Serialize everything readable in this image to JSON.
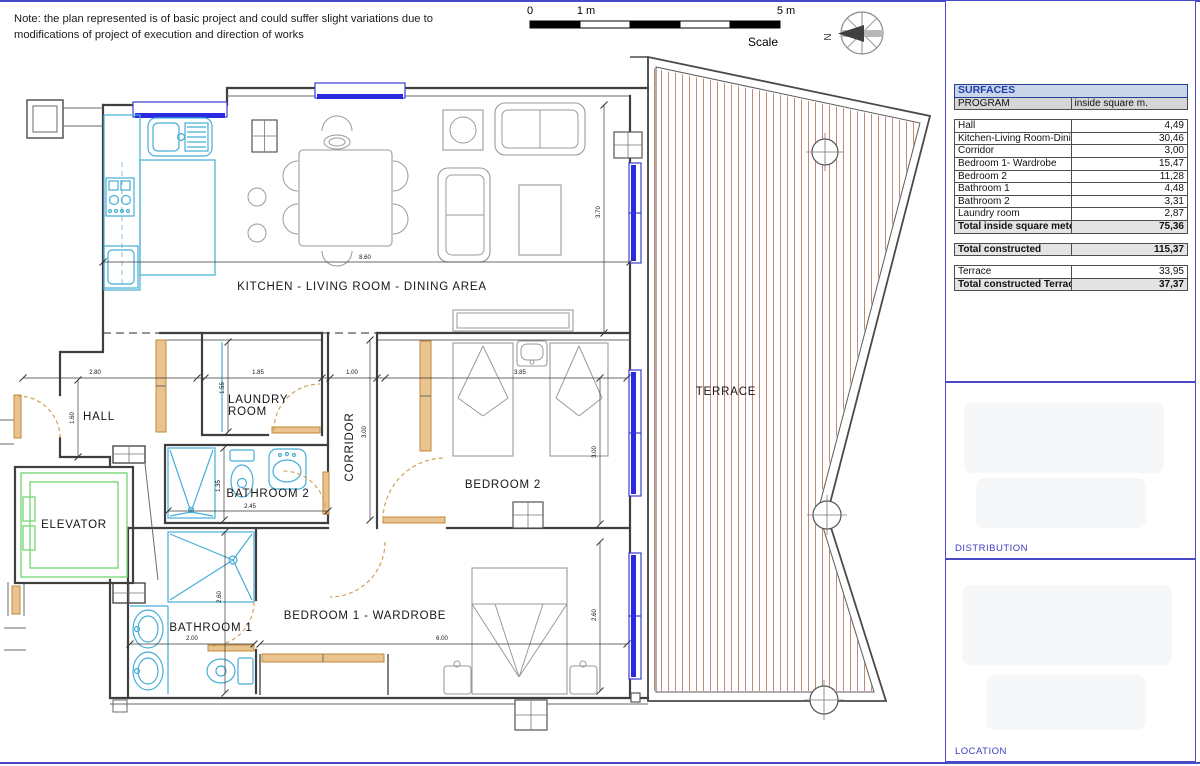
{
  "note": {
    "text": "Note: the plan represented is of basic project and could suffer slight variations due to modifications of project of execution and direction of works"
  },
  "scalebar": {
    "tick0": "0",
    "tick1": "1 m",
    "tick5": "5 m",
    "label": "Scale"
  },
  "compass": {
    "north": "N"
  },
  "plan": {
    "rooms": {
      "kitchen": "KITCHEN - LIVING ROOM - DINING AREA",
      "hall": "HALL",
      "laundry_line1": "LAUNDRY",
      "laundry_line2": "ROOM",
      "corridor": "CORRIDOR",
      "bathroom2": "BATHROOM 2",
      "bedroom2": "BEDROOM 2",
      "elevator": "ELEVATOR",
      "bathroom1": "BATHROOM 1",
      "bedroom1": "BEDROOM 1 - WARDROBE",
      "terrace": "TERRACE"
    },
    "dims": {
      "kitchen_width": "8.60",
      "living_height": "3.70",
      "hall_width": "2.80",
      "hall_height": "1.60",
      "laundry_width": "1.85",
      "laundry_height": "1.55",
      "corridor_width": "1.00",
      "corridor_height": "3.00",
      "bedroom2_width": "3.85",
      "bedroom2_height": "3.00",
      "bathroom2_width": "2.45",
      "bathroom2_height": "1.35",
      "bathroom1_width": "2.00",
      "bathroom1_height": "2.60",
      "bedroom1_width": "6.00",
      "bedroom1_height": "2.60"
    }
  },
  "panel": {
    "table": {
      "title": "SURFACES",
      "col1": "PROGRAM",
      "col2": "inside square m.",
      "rows": [
        {
          "label": "",
          "value": "",
          "type": "spacer"
        },
        {
          "label": "Hall",
          "value": "4,49",
          "type": "normal"
        },
        {
          "label": "Kitchen-Living Room-Dining area",
          "value": "30,46",
          "type": "normal"
        },
        {
          "label": "Corridor",
          "value": "3,00",
          "type": "normal"
        },
        {
          "label": "Bedroom 1- Wardrobe",
          "value": "15,47",
          "type": "normal"
        },
        {
          "label": "Bedroom 2",
          "value": "11,28",
          "type": "normal"
        },
        {
          "label": "Bathroom 1",
          "value": "4,48",
          "type": "normal"
        },
        {
          "label": "Bathroom 2",
          "value": "3,31",
          "type": "normal"
        },
        {
          "label": "Laundry room",
          "value": "2,87",
          "type": "normal"
        },
        {
          "label": "Total inside square meter",
          "value": "75,36",
          "type": "total"
        },
        {
          "label": "",
          "value": "",
          "type": "spacer"
        },
        {
          "label": "Total constructed",
          "value": "115,37",
          "type": "total"
        },
        {
          "label": "",
          "value": "",
          "type": "spacer"
        },
        {
          "label": "Terrace",
          "value": "33,95",
          "type": "normal"
        },
        {
          "label": "Total constructed Terraces",
          "value": "37,37",
          "type": "total"
        }
      ]
    },
    "distribution_label": "DISTRIBUTION",
    "location_label": "LOCATION"
  },
  "colors": {
    "accent_blue": "#4a4ac8",
    "window_blue": "#2a2ae0",
    "door_orange": "#cf9a4a",
    "fixture_cyan": "#45aed6",
    "elevator_green": "#7cd87c",
    "terrace_hatch": "#c28a74",
    "wall_gray": "#3f3f3f",
    "table_header_bg": "#cbd5ea",
    "table_header_text": "#1e3fa9"
  }
}
